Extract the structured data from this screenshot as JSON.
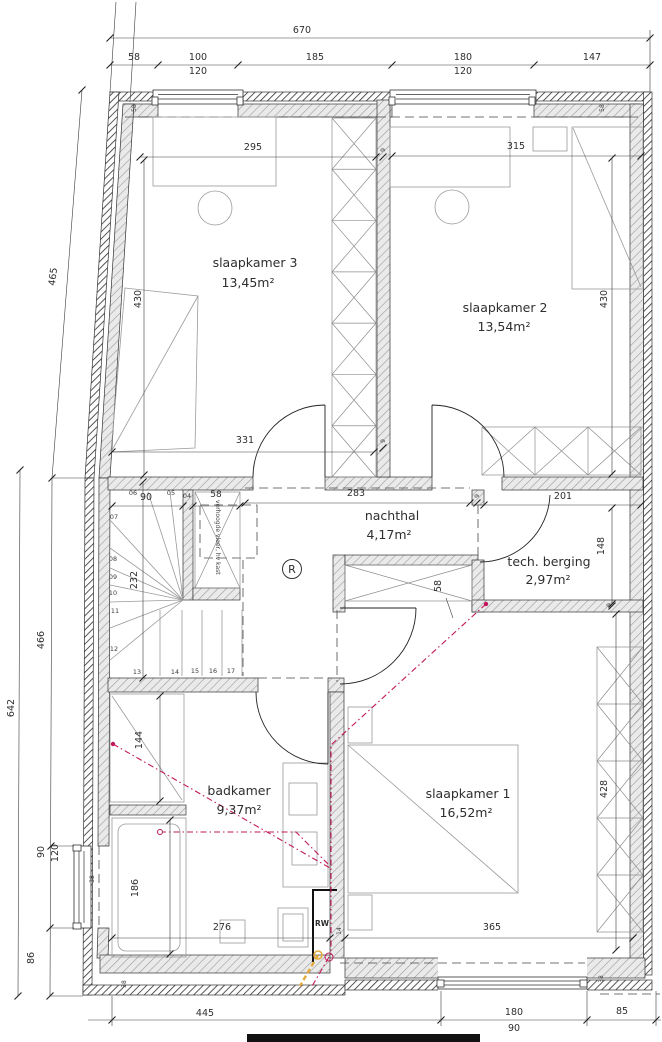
{
  "rooms": {
    "sk3": {
      "name": "slaapkamer 3",
      "area": "13,45m²"
    },
    "sk2": {
      "name": "slaapkamer 2",
      "area": "13,54m²"
    },
    "hall": {
      "name": "nachthal",
      "area": "4,17m²"
    },
    "tech": {
      "name": "tech. berging",
      "area": "2,97m²"
    },
    "bath": {
      "name": "badkamer",
      "area": "9,37m²"
    },
    "sk1": {
      "name": "slaapkamer 1",
      "area": "16,52m²"
    }
  },
  "dims": {
    "top": {
      "overall": "670",
      "seg1": "58",
      "seg2": "100",
      "seg2h": "120",
      "seg3": "185",
      "seg4": "180",
      "seg4h": "120",
      "seg5": "147"
    },
    "left": {
      "top": "465",
      "mid": "466",
      "overall": "642",
      "win": "90",
      "winh": "120",
      "bottom": "86"
    },
    "bottom": {
      "seg1": "445",
      "seg2": "180",
      "winh": "90",
      "seg3": "85"
    },
    "rooms": {
      "sk3w": "295",
      "sk3d": "430",
      "sk3b": "331",
      "sk2w": "315",
      "sk2d": "430",
      "hallw": "283",
      "techw": "201",
      "techd": "148",
      "stairsd": "232",
      "stairsw": "90",
      "staircloset": "58",
      "hallcloset": "58",
      "shower": "144",
      "bathtub": "186",
      "bathw": "276",
      "sk1w": "365",
      "sk1closet": "428"
    },
    "walls": {
      "w9a": "9",
      "w9b": "9",
      "w9c": "9",
      "w9d": "9",
      "w14": "14",
      "w38a": "38",
      "w38b": "38",
      "w38c": "38",
      "w58a": "58",
      "w58b": "58"
    }
  },
  "stairs": {
    "steps": [
      "04",
      "05",
      "06",
      "07",
      "08",
      "09",
      "10",
      "11",
      "12",
      "13",
      "14",
      "15",
      "16",
      "17"
    ]
  },
  "annotations": {
    "closet_note": "verhoogde vloer, hv kast",
    "smoke": "R",
    "rw": "RW"
  },
  "colors": {
    "sanitary": "#c2185b",
    "gas": "#e2a93b",
    "rainwater": "#3aa7dc"
  }
}
